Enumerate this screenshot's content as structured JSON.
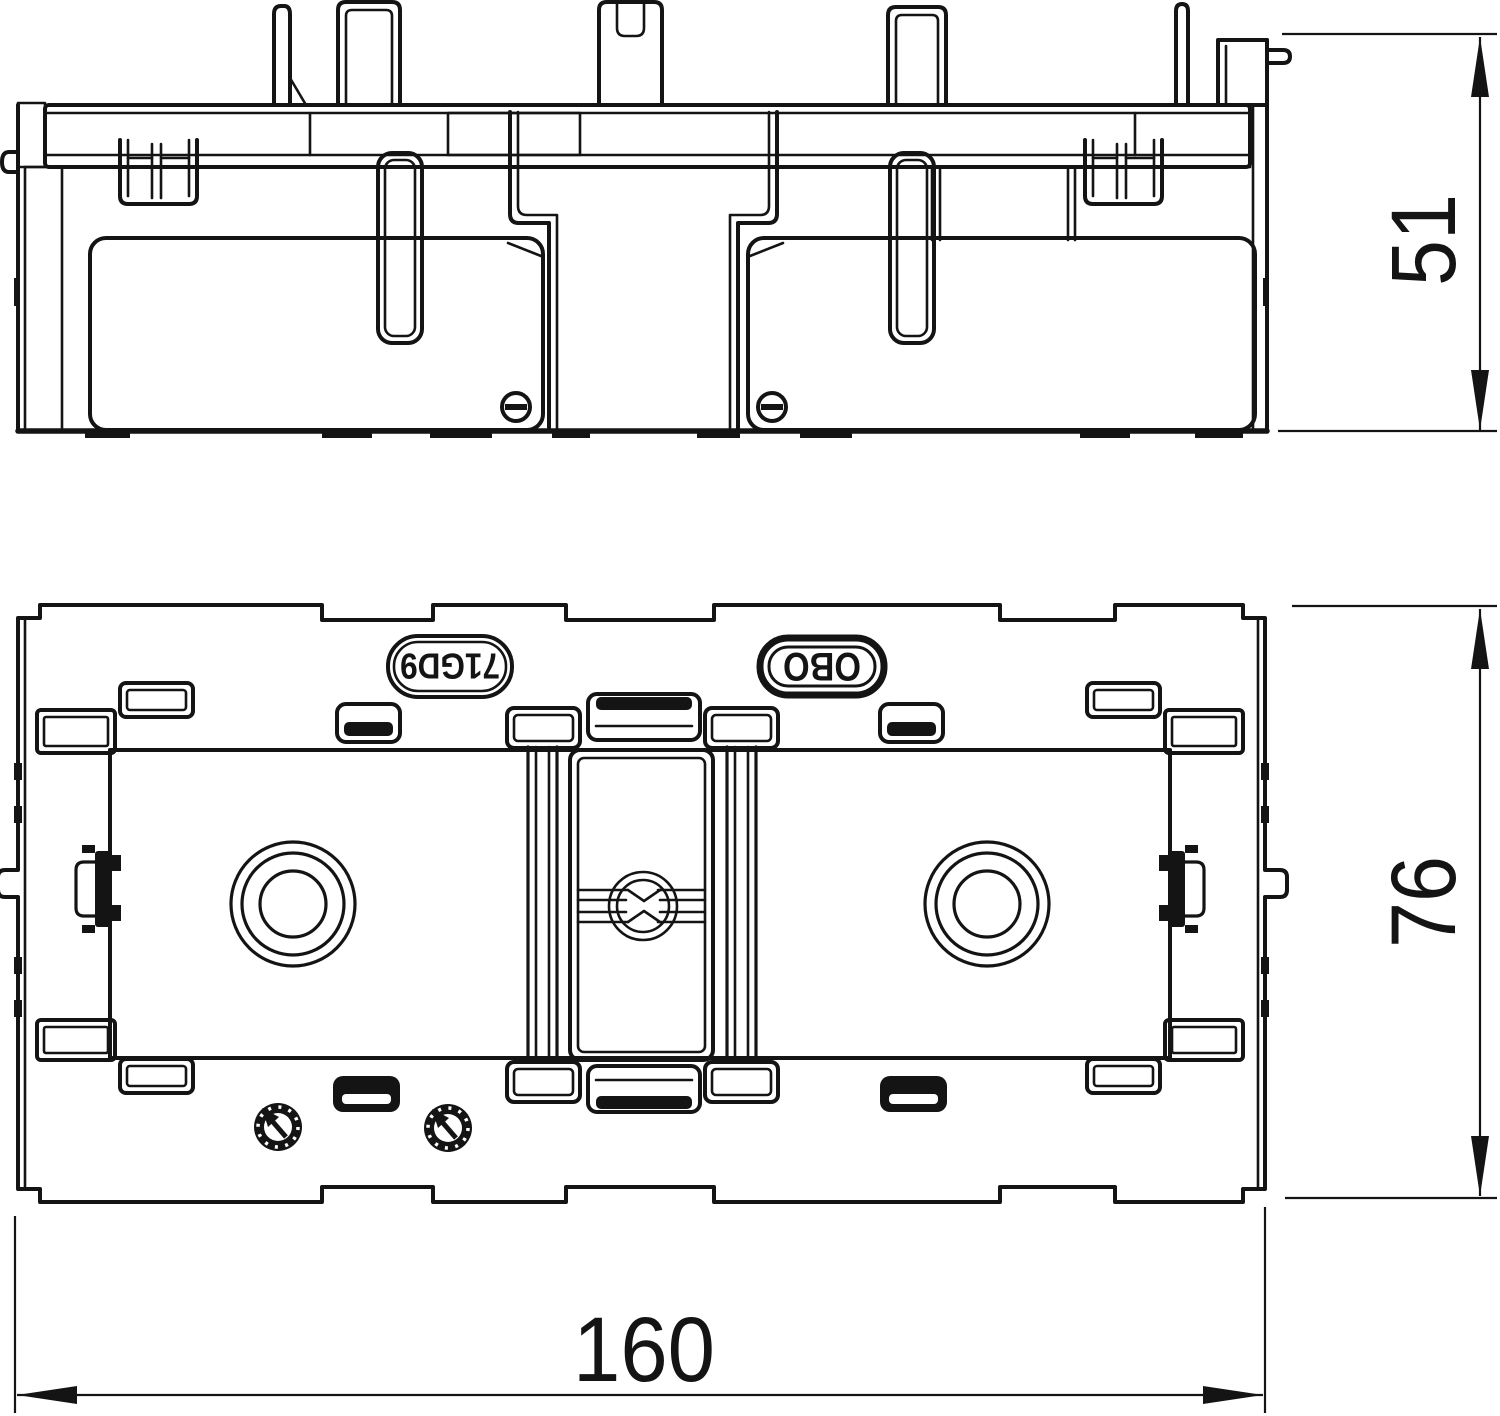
{
  "drawing": {
    "type": "technical-drawing",
    "labels": {
      "product_code": "71GD9",
      "brand": "OBO"
    },
    "dimensions": {
      "side_height_mm": "51",
      "plan_height_mm": "76",
      "overall_width_mm": "160"
    },
    "colors": {
      "line": "#141414",
      "background": "#ffffff"
    }
  }
}
